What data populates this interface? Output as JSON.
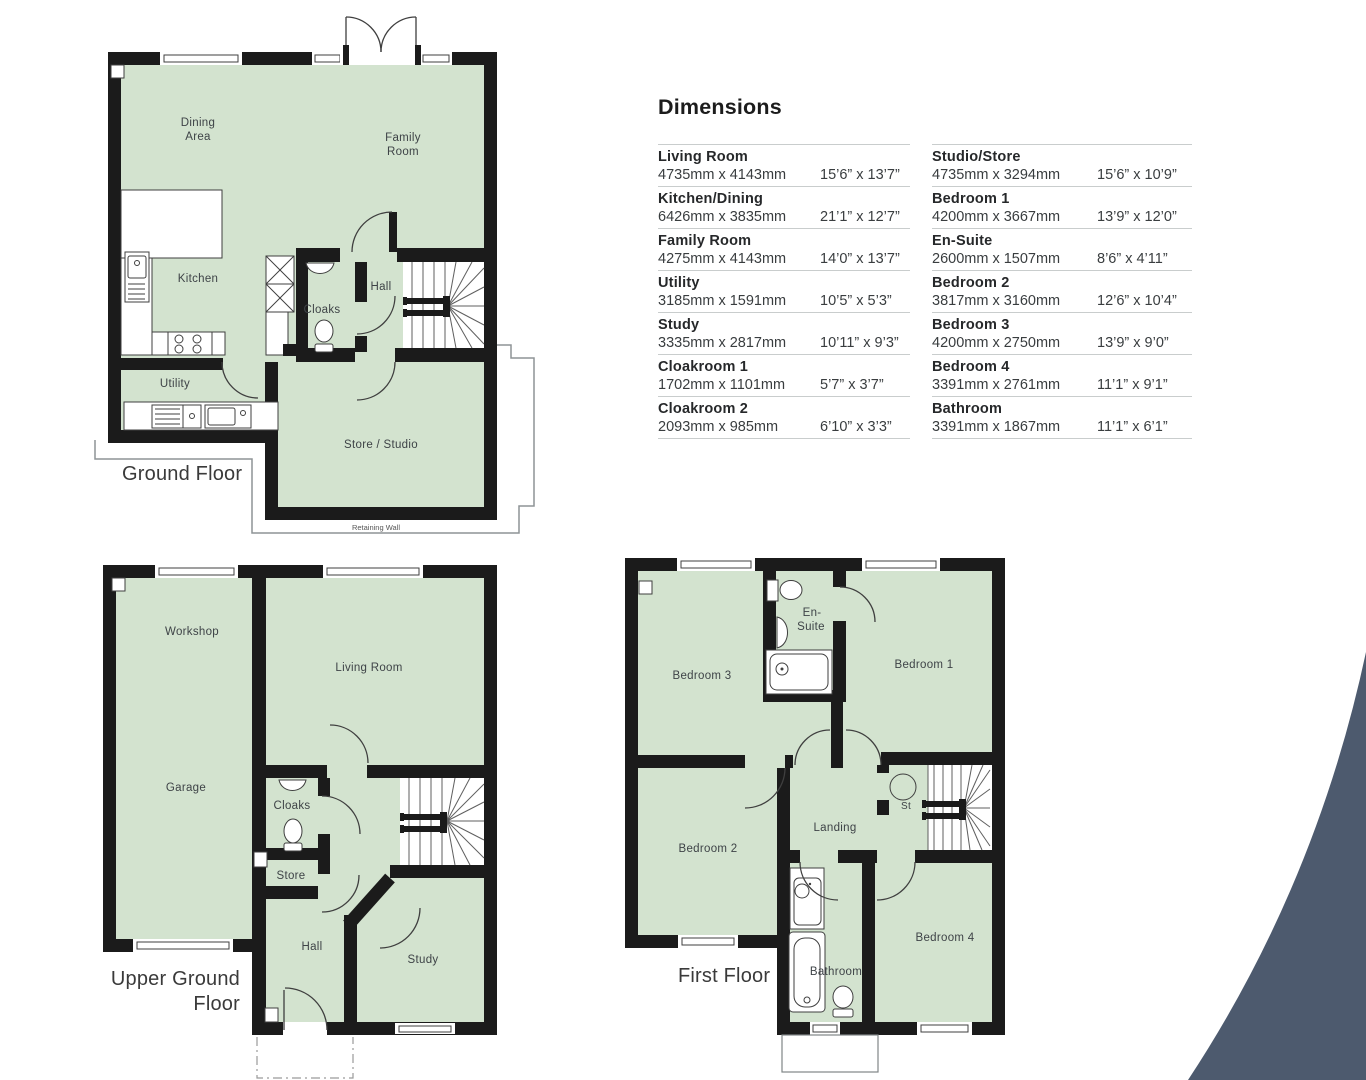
{
  "dims": {
    "title": "Dimensions",
    "left": [
      {
        "name": "Living Room",
        "metric": "4735mm x 4143mm",
        "imperial": "15’6” x 13’7”"
      },
      {
        "name": "Kitchen/Dining",
        "metric": "6426mm x 3835mm",
        "imperial": "21’1” x 12’7”"
      },
      {
        "name": "Family Room",
        "metric": "4275mm x 4143mm",
        "imperial": "14’0” x 13’7”"
      },
      {
        "name": "Utility",
        "metric": "3185mm x 1591mm",
        "imperial": "10’5” x 5’3”"
      },
      {
        "name": "Study",
        "metric": "3335mm x 2817mm",
        "imperial": "10’11” x 9’3”"
      },
      {
        "name": "Cloakroom 1",
        "metric": "1702mm x 1101mm",
        "imperial": "5’7” x 3’7”"
      },
      {
        "name": "Cloakroom 2",
        "metric": "2093mm x 985mm",
        "imperial": "6’10” x 3’3”"
      }
    ],
    "right": [
      {
        "name": "Studio/Store",
        "metric": "4735mm x 3294mm",
        "imperial": "15’6” x 10’9”"
      },
      {
        "name": "Bedroom 1",
        "metric": "4200mm x 3667mm",
        "imperial": "13’9” x 12’0”"
      },
      {
        "name": "En-Suite",
        "metric": "2600mm x 1507mm",
        "imperial": "8’6” x 4’11”"
      },
      {
        "name": "Bedroom 2",
        "metric": "3817mm x 3160mm",
        "imperial": "12’6” x 10’4”"
      },
      {
        "name": "Bedroom 3",
        "metric": "4200mm x 2750mm",
        "imperial": "13’9” x 9’0”"
      },
      {
        "name": "Bedroom 4",
        "metric": "3391mm x 2761mm",
        "imperial": "11’1” x 9’1”"
      },
      {
        "name": "Bathroom",
        "metric": "3391mm x 1867mm",
        "imperial": "11’1” x 6’1”"
      }
    ]
  },
  "floors": {
    "ground": {
      "label": "Ground Floor",
      "retaining": "Retaining Wall",
      "rooms": {
        "dining1": "Dining",
        "dining2": "Area",
        "family1": "Family",
        "family2": "Room",
        "kitchen": "Kitchen",
        "cloaks": "Cloaks",
        "hall": "Hall",
        "utility": "Utility",
        "store": "Store / Studio"
      }
    },
    "upper": {
      "label1": "Upper Ground",
      "label2": "Floor",
      "rooms": {
        "workshop": "Workshop",
        "living": "Living Room",
        "garage": "Garage",
        "cloaks": "Cloaks",
        "store": "Store",
        "hall": "Hall",
        "study": "Study"
      }
    },
    "first": {
      "label": "First Floor",
      "rooms": {
        "bed3": "Bedroom 3",
        "ens1": "En-",
        "ens2": "Suite",
        "bed1": "Bedroom 1",
        "bed2": "Bedroom 2",
        "landing": "Landing",
        "st": "St",
        "bed4": "Bedroom 4",
        "bathroom": "Bathroom"
      }
    }
  },
  "colors": {
    "room_fill": "#d3e3cf",
    "wall": "#1b1b1b",
    "accent_wedge": "#4d5a6e"
  }
}
